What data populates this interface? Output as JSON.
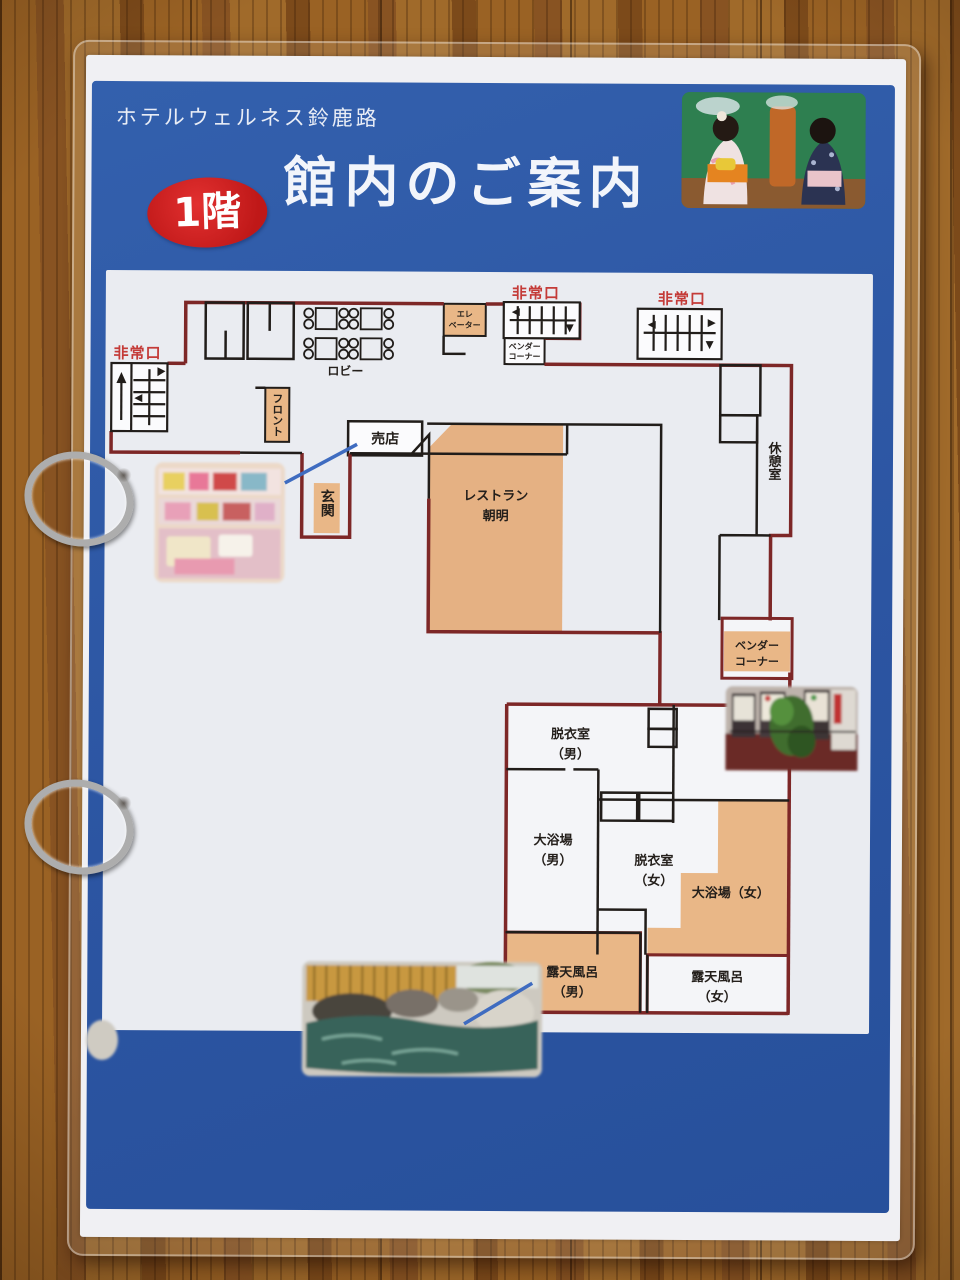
{
  "header": {
    "hotel_name": "ホテルウェルネス鈴鹿路",
    "title": "館内のご案内",
    "floor_badge": "1階"
  },
  "floorplan": {
    "exits": {
      "left": "非常口",
      "top": "非常口",
      "right": "非常口"
    },
    "lobby": "ロビー",
    "elevator": {
      "l1": "エレ",
      "l2": "ベーター"
    },
    "vendor_small": {
      "l1": "ベンダー",
      "l2": "コーナー"
    },
    "front": "フロント",
    "shop": "売店",
    "entrance": "玄関",
    "restaurant": {
      "l1": "レストラン",
      "l2": "朝明"
    },
    "lounge": "休憩室",
    "vendor": {
      "l1": "ベンダー",
      "l2": "コーナー"
    },
    "changing_men": {
      "l1": "脱衣室",
      "l2": "（男）"
    },
    "bath_men": {
      "l1": "大浴場",
      "l2": "（男）"
    },
    "changing_women": {
      "l1": "脱衣室",
      "l2": "（女）"
    },
    "bath_women": "大浴場（女）",
    "open_air_men": {
      "l1": "露天風呂",
      "l2": "（男）"
    },
    "open_air_women": {
      "l1": "露天風呂",
      "l2": "（女）"
    }
  },
  "photos": {
    "shop": "shop-display-photo",
    "vending": "vending-machines-photo",
    "open_air_bath": "open-air-bath-photo",
    "kimono": "kimono-guests-photo"
  },
  "colors": {
    "panel_blue": "#2d57a5",
    "wall_red": "#7d2727",
    "wall_black": "#211d1a",
    "room_orange": "#e9b787",
    "exit_red": "#c43b38",
    "badge_red": "#ce2323"
  }
}
